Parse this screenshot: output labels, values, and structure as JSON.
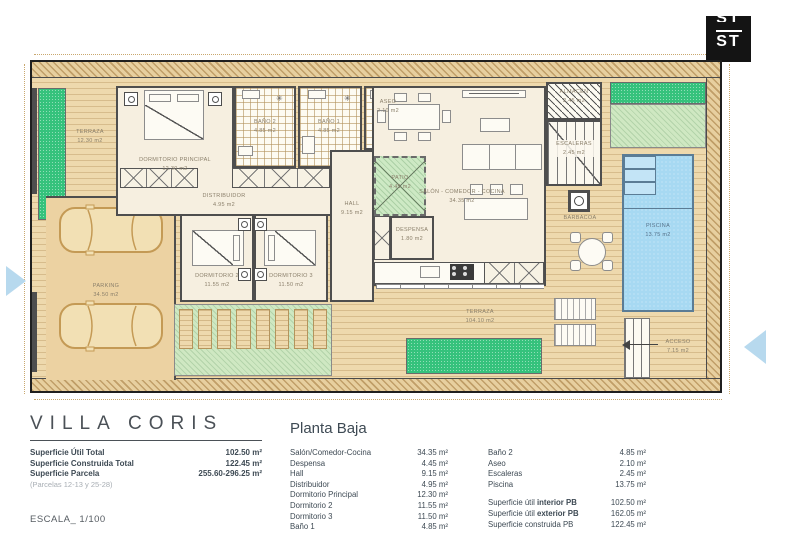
{
  "logo": {
    "top": "ST",
    "bottom": "ST"
  },
  "plan": {
    "rooms": {
      "terraza_nw": {
        "name": "TERRAZA",
        "area": "12.30 m2"
      },
      "dormitorio_principal": {
        "name": "DORMITORIO PRINCIPAL",
        "area": "12.30 m2"
      },
      "bano2": {
        "name": "BAÑO 2",
        "area": "4.85 m2"
      },
      "bano1": {
        "name": "BAÑO 1",
        "area": "4.85 m2"
      },
      "aseo": {
        "name": "ASEO",
        "area": "2.10 m2"
      },
      "distribuidor": {
        "name": "DISTRIBUIDOR",
        "area": "4.95 m2"
      },
      "hall": {
        "name": "HALL",
        "area": "9.15 m2"
      },
      "patio": {
        "name": "PATIO",
        "area": "4.45 m2"
      },
      "salon": {
        "name": "SALÓN - COMEDOR - COCINA",
        "area": "34.35 m2"
      },
      "despensa": {
        "name": "DESPENSA",
        "area": "1.80 m2"
      },
      "dormitorio2": {
        "name": "DORMITORIO 2",
        "area": "11.55 m2"
      },
      "dormitorio3": {
        "name": "DORMITORIO 3",
        "area": "11.50 m2"
      },
      "parking": {
        "name": "PARKING",
        "area": "34.50 m2"
      },
      "almacen": {
        "name": "ALMACÉN",
        "area": "2.45 m2"
      },
      "escaleras": {
        "name": "ESCALERAS",
        "area": "2.45 m2"
      },
      "barbacoa": {
        "name": "BARBACOA",
        "area": ""
      },
      "piscina": {
        "name": "PISCINA",
        "area": "13.75 m2"
      },
      "terraza_main": {
        "name": "TERRAZA",
        "area": "104.10 m2"
      },
      "acceso": {
        "name": "ACCESO",
        "area": "7.15 m2"
      }
    }
  },
  "title_block": {
    "title": "VILLA CORIS",
    "rows": [
      {
        "label": "Superficie Útil Total",
        "value": "102.50 m²"
      },
      {
        "label": "Superficie Construida Total",
        "value": "122.45 m²"
      },
      {
        "label": "Superficie Parcela",
        "value": "255.60-296.25 m²"
      }
    ],
    "note": "(Parcelas 12-13 y 25-28)",
    "scale": "ESCALA_ 1/100"
  },
  "legend": {
    "heading": "Planta Baja",
    "col1": [
      {
        "label": "Salón/Comedor-Cocina",
        "value": "34.35 m²"
      },
      {
        "label": "Despensa",
        "value": "4.45 m²"
      },
      {
        "label": "Hall",
        "value": "9.15 m²"
      },
      {
        "label": "Distribuidor",
        "value": "4.95 m²"
      },
      {
        "label": "Dormitorio Principal",
        "value": "12.30 m²"
      },
      {
        "label": "Dormitorio 2",
        "value": "11.55 m²"
      },
      {
        "label": "Dormitorio 3",
        "value": "11.50 m²"
      },
      {
        "label": "Baño 1",
        "value": "4.85 m²"
      }
    ],
    "col2": [
      {
        "label": "Baño 2",
        "value": "4.85 m²"
      },
      {
        "label": "Aseo",
        "value": "2.10 m²"
      },
      {
        "label": "Escaleras",
        "value": "2.45 m²"
      },
      {
        "label": "Piscina",
        "value": "13.75 m²"
      }
    ],
    "totals": [
      {
        "prefix": "Superficie útil ",
        "bold": "interior PB",
        "value": "102.50 m²"
      },
      {
        "prefix": "Superficie útil ",
        "bold": "exterior PB",
        "value": "162.05 m²"
      },
      {
        "prefix": "Superficie construida PB",
        "bold": "",
        "value": "122.45 m²"
      }
    ]
  },
  "colors": {
    "wall": "#4e4e4e",
    "deck": "#eed9ad",
    "grass": "#35c27c",
    "grass_light": "#cfe8c2",
    "pool": "#a7d9f2",
    "text": "#3e4a54",
    "plan_label": "#8a7f6a",
    "arrow": "#b7d9ee"
  }
}
